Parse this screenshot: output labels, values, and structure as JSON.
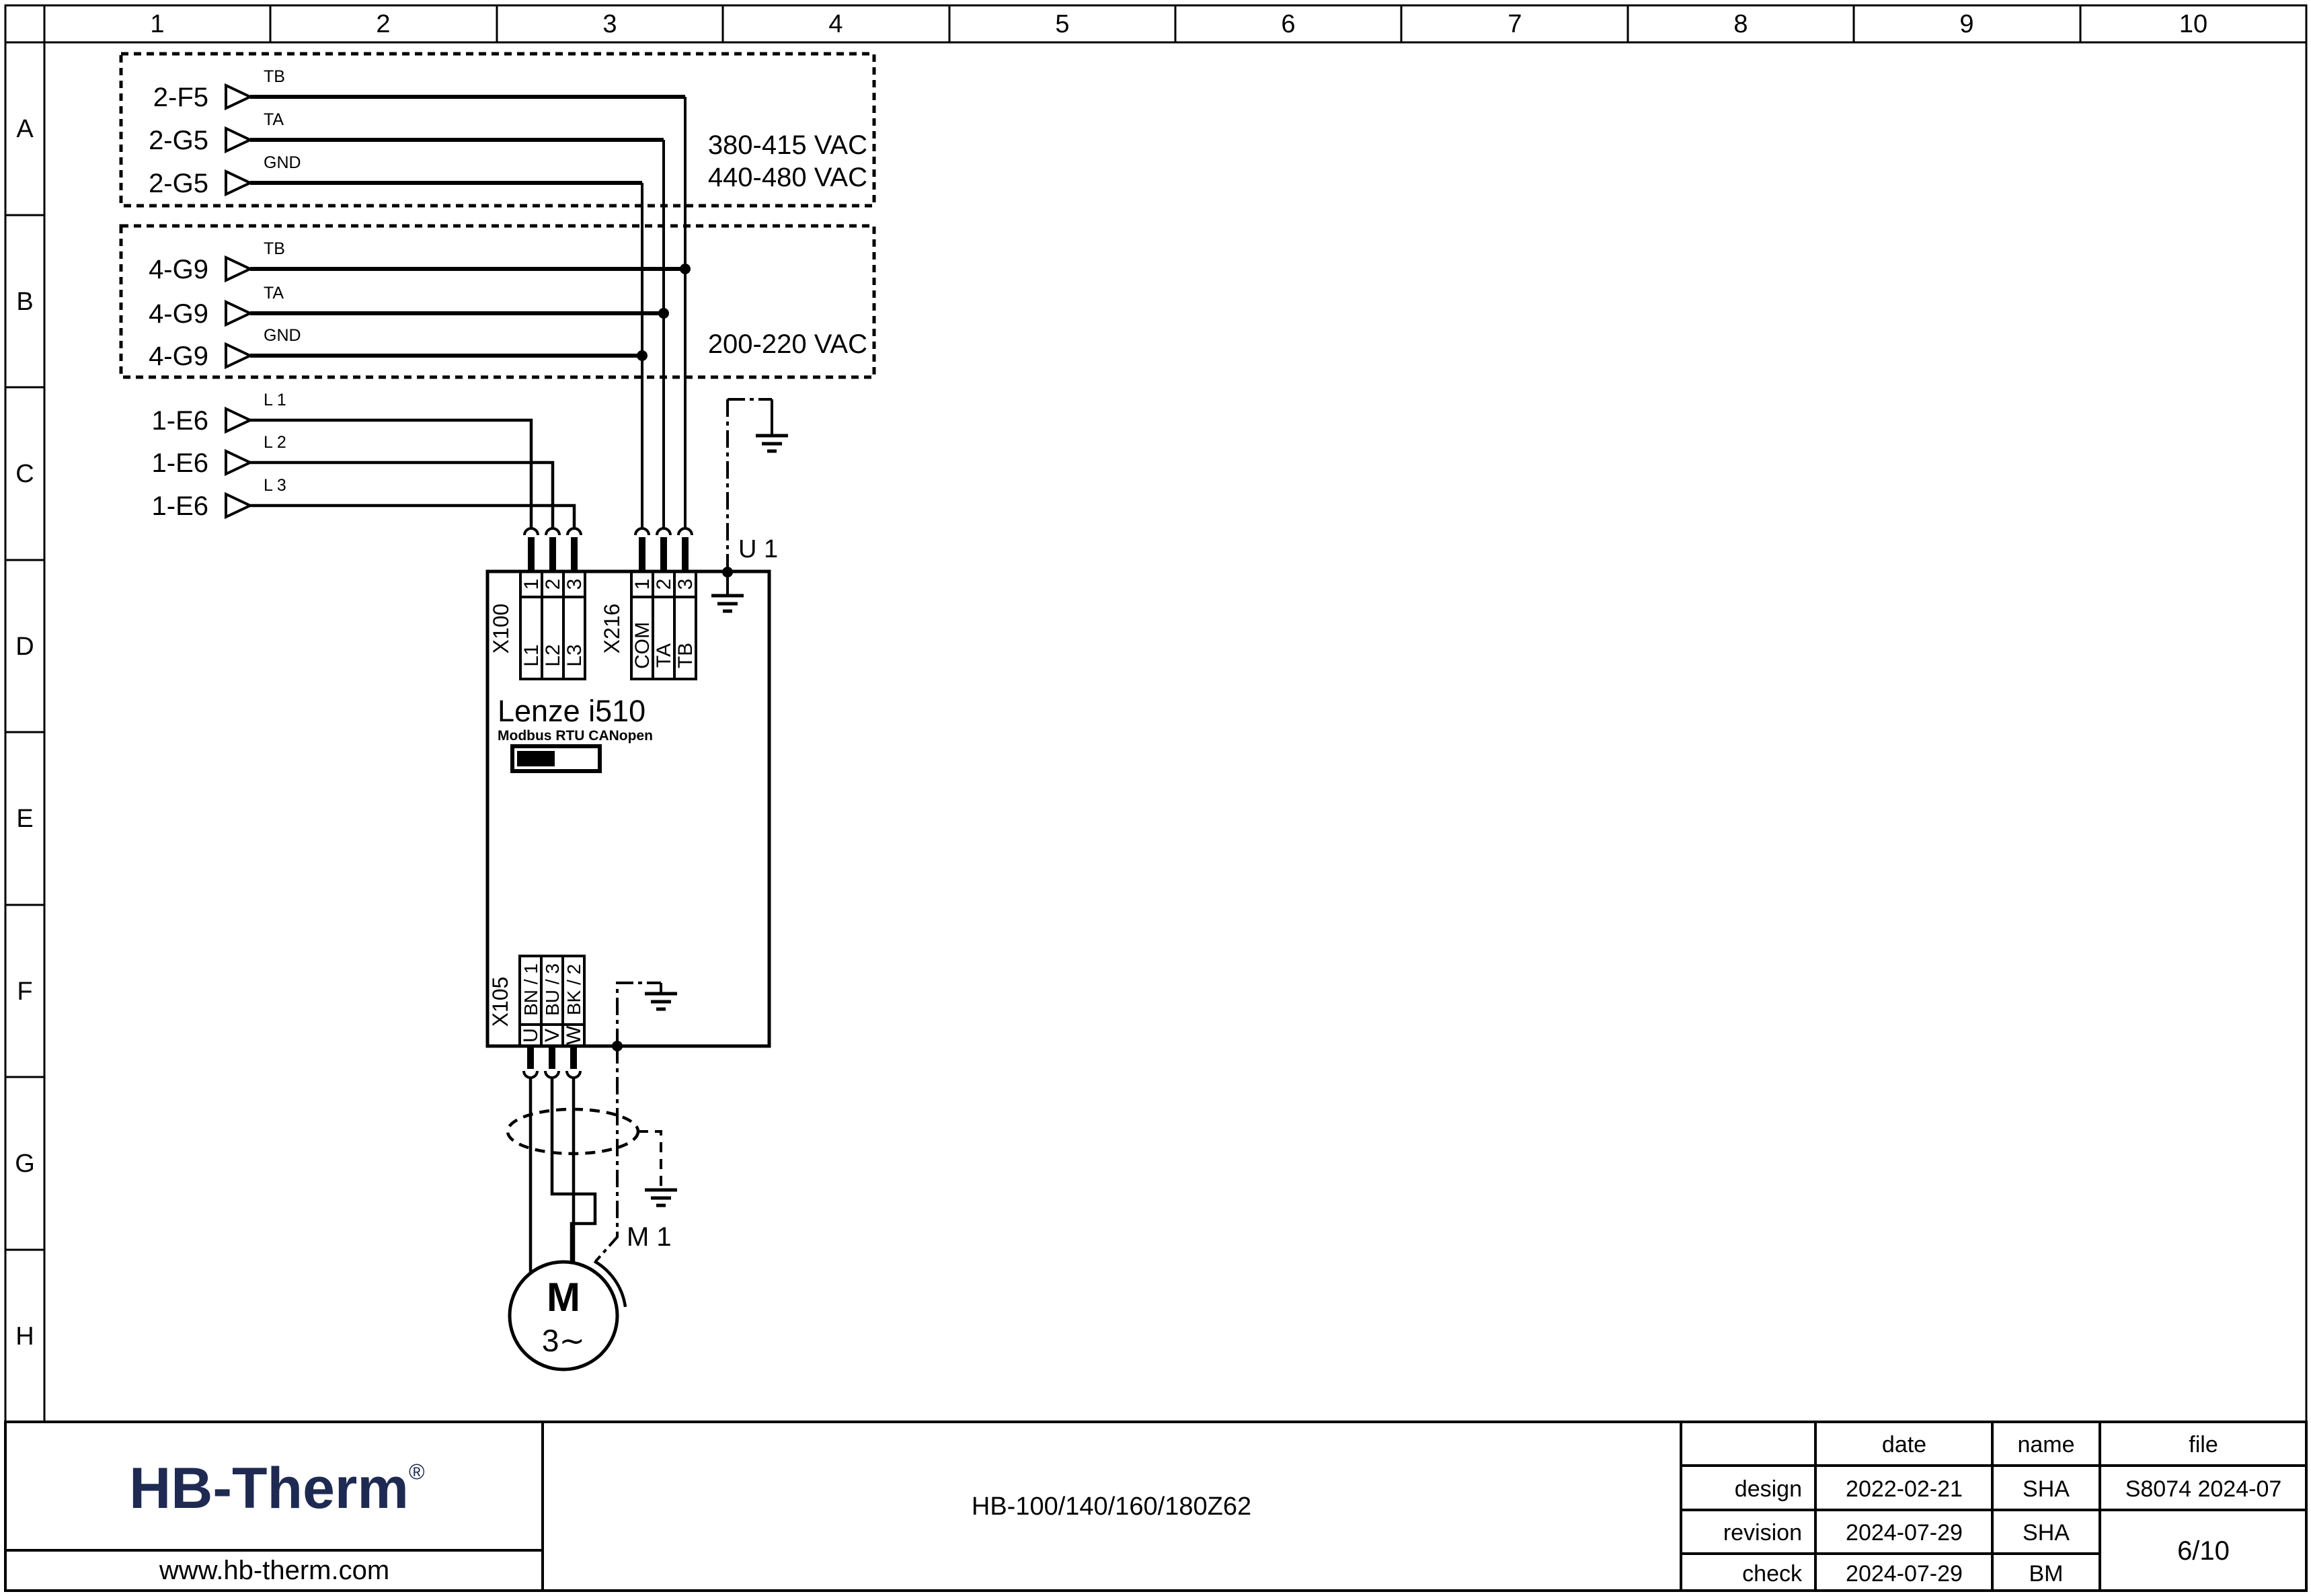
{
  "colors": {
    "line": "#000000",
    "logo_navy": "#1e2a52",
    "background": "#ffffff"
  },
  "ruler": {
    "columns": [
      "1",
      "2",
      "3",
      "4",
      "5",
      "6",
      "7",
      "8",
      "9",
      "10"
    ],
    "rows": [
      "A",
      "B",
      "C",
      "D",
      "E",
      "F",
      "G",
      "H"
    ]
  },
  "box_a": {
    "rows": [
      {
        "ref": "2-F5",
        "signal": "TB"
      },
      {
        "ref": "2-G5",
        "signal": "TA"
      },
      {
        "ref": "2-G5",
        "signal": "GND"
      }
    ],
    "voltage1": "380-415 VAC",
    "voltage2": "440-480 VAC"
  },
  "box_b": {
    "rows": [
      {
        "ref": "4-G9",
        "signal": "TB"
      },
      {
        "ref": "4-G9",
        "signal": "TA"
      },
      {
        "ref": "4-G9",
        "signal": "GND"
      }
    ],
    "voltage1": "200-220 VAC"
  },
  "mains": {
    "rows": [
      {
        "ref": "1-E6",
        "signal": "L 1"
      },
      {
        "ref": "1-E6",
        "signal": "L 2"
      },
      {
        "ref": "1-E6",
        "signal": "L 3"
      }
    ]
  },
  "drive": {
    "designator": "U 1",
    "model": "Lenze i510",
    "comm_label": "Modbus RTU CANopen",
    "x100": {
      "name": "X100",
      "pins": [
        "1",
        "2",
        "3"
      ],
      "wires": [
        "L1",
        "L2",
        "L3"
      ]
    },
    "x216": {
      "name": "X216",
      "pins": [
        "1",
        "2",
        "3"
      ],
      "wires": [
        "COM",
        "TA",
        "TB"
      ]
    },
    "x105": {
      "name": "X105",
      "pins": [
        "U",
        "V",
        "W"
      ],
      "wires": [
        "BN / 1",
        "BU / 3",
        "BK / 2"
      ]
    }
  },
  "motor": {
    "designator": "M 1",
    "letter": "M",
    "phases": "3∼"
  },
  "title_block": {
    "logo_text": "HB-Therm",
    "logo_mark": "®",
    "website": "www.hb-therm.com",
    "drawing_title": "HB-100/140/160/180Z62",
    "headers": {
      "date": "date",
      "name": "name",
      "file": "file"
    },
    "rows": [
      {
        "label": "design",
        "date": "2022-02-21",
        "name": "SHA"
      },
      {
        "label": "revision",
        "date": "2024-07-29",
        "name": "SHA"
      },
      {
        "label": "check",
        "date": "2024-07-29",
        "name": "BM"
      }
    ],
    "file_value": "S8074 2024-07",
    "page": "6/10"
  }
}
